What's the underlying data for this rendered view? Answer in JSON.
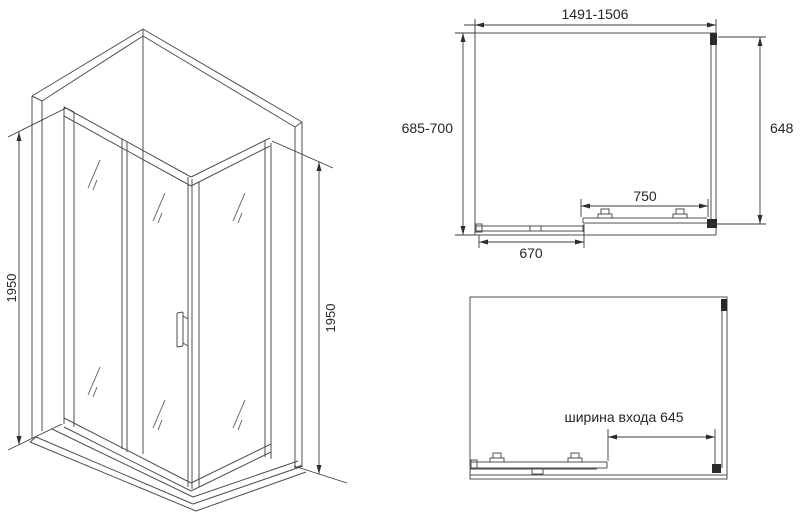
{
  "drawing": {
    "type": "shower-enclosure-technical-drawing",
    "background": "#ffffff",
    "line_color": "#4f4f4f",
    "dimension_color": "#3c3c3c",
    "text_color": "#262626",
    "labels": {
      "height_left": "1950",
      "height_right": "1950",
      "width_total": "1491-1506",
      "depth_total": "685-700",
      "side_panel": "648",
      "door_panel": "750",
      "fixed_panel": "670",
      "entrance_width": "ширина входа 645"
    }
  }
}
